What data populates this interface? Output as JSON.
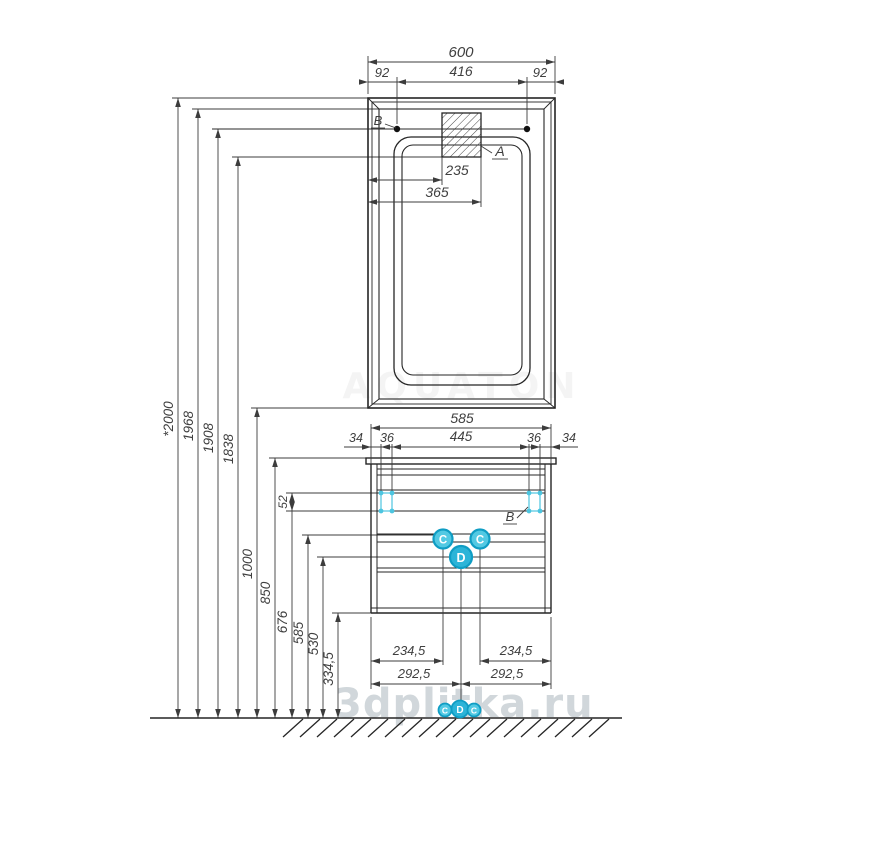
{
  "watermark": {
    "text": "3dplitka.ru",
    "ghost": "AQUATON"
  },
  "mirror": {
    "dim_total_width": "600",
    "dim_left_offset": "92",
    "dim_center_span": "416",
    "dim_right_offset": "92",
    "dim_lamp_left": "235",
    "dim_lamp_right": "365",
    "marker_a": "A",
    "marker_b": "B"
  },
  "heights": {
    "labels": [
      "*2000",
      "1968",
      "1908",
      "1838",
      "1000",
      "850",
      "676",
      "585",
      "530",
      "334,5"
    ],
    "bracket_height": "52"
  },
  "cabinet": {
    "dim_total_width": "585",
    "segments": [
      "34",
      "36",
      "445",
      "36",
      "34"
    ],
    "marker_b": "B",
    "marker_c_left": "C",
    "marker_c_right": "C",
    "marker_d": "D",
    "dim_inner_left": "234,5",
    "dim_inner_right": "234,5",
    "dim_half_left": "292,5",
    "dim_half_right": "292,5"
  },
  "floor_markers": {
    "left": "C",
    "center": "D",
    "right": "C"
  },
  "colors": {
    "line": "#2a2a2a",
    "dim": "#3c3c3c",
    "accent": "#3fc0dd",
    "accent_dark": "#0f9dc4",
    "watermark": "#c9d1d5"
  }
}
